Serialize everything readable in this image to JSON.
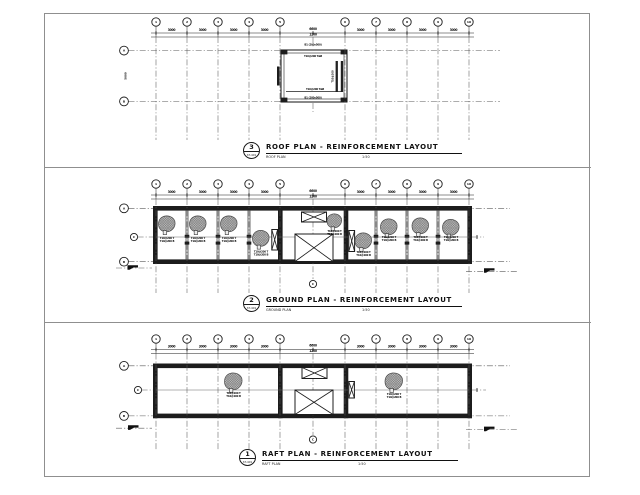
{
  "colors": {
    "line": "#1c1c1c",
    "grid_line": "#5a5a5a",
    "hatch_fill": "#c7c7c7",
    "hatch_stroke": "#6f6f6f",
    "border": "#8f8f8f"
  },
  "grid": {
    "column_labels": [
      "1",
      "2",
      "3",
      "4",
      "5",
      "6",
      "7",
      "8",
      "9",
      "10"
    ],
    "row_label_a": "A",
    "row_label_b": "B",
    "center_row_label": "C",
    "center_column_label": "C"
  },
  "dimensions": {
    "bay": "3000",
    "middle_top": "6600",
    "middle_bottom": "1200",
    "side": "5000"
  },
  "notes": {
    "slab_line1": "T10@200 T",
    "slab_line2": "T10@200 B",
    "roof_edge": "B1 (200x500)",
    "roof_inner": "T10@200 T&B",
    "roof_side": "T10@200"
  },
  "panels": [
    {
      "id": "roof",
      "callout_number": "3",
      "callout_sheet": "ST-401",
      "title": "ROOF PLAN - REINFORCEMENT LAYOUT",
      "subtitle": "ROOF PLAN",
      "scale": "1:50"
    },
    {
      "id": "ground",
      "callout_number": "2",
      "callout_sheet": "ST-401",
      "title": "GROUND PLAN - REINFORCEMENT LAYOUT",
      "subtitle": "GROUND PLAN",
      "scale": "1:50"
    },
    {
      "id": "raft",
      "callout_number": "1",
      "callout_sheet": "ST-401",
      "title": "RAFT PLAN - REINFORCEMENT LAYOUT",
      "subtitle": "RAFT PLAN",
      "scale": "1:50"
    }
  ]
}
